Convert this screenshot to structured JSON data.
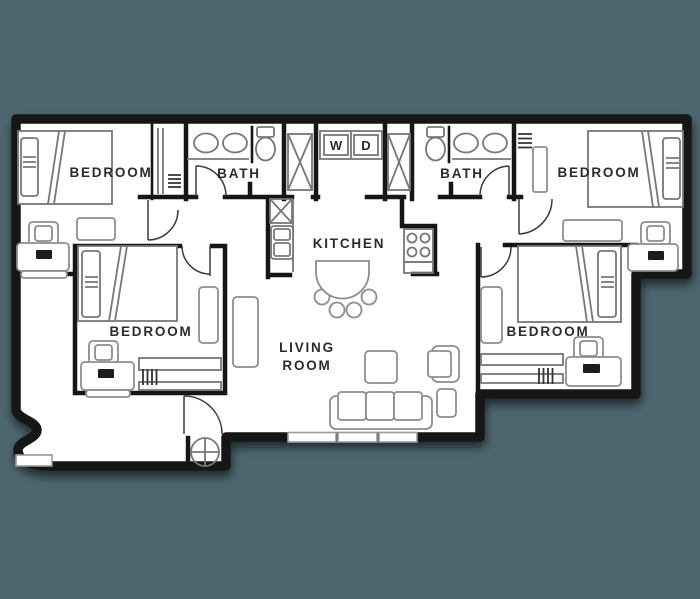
{
  "colors": {
    "background": "#4d6770",
    "wall": "#161616",
    "furniture": "#8d8d8d",
    "fixture": "#777777",
    "floor": "#ffffff",
    "text": "#2b2b2b"
  },
  "floorplan": {
    "labels": {
      "bedroom_top_left": "BEDROOM",
      "bedroom_top_right": "BEDROOM",
      "bedroom_bottom_left": "BEDROOM",
      "bedroom_bottom_right": "BEDROOM",
      "bath_left": "BATH",
      "bath_right": "BATH",
      "kitchen": "KITCHEN",
      "living_room_line1": "LIVING",
      "living_room_line2": "ROOM",
      "washer": "W",
      "dryer": "D"
    }
  }
}
